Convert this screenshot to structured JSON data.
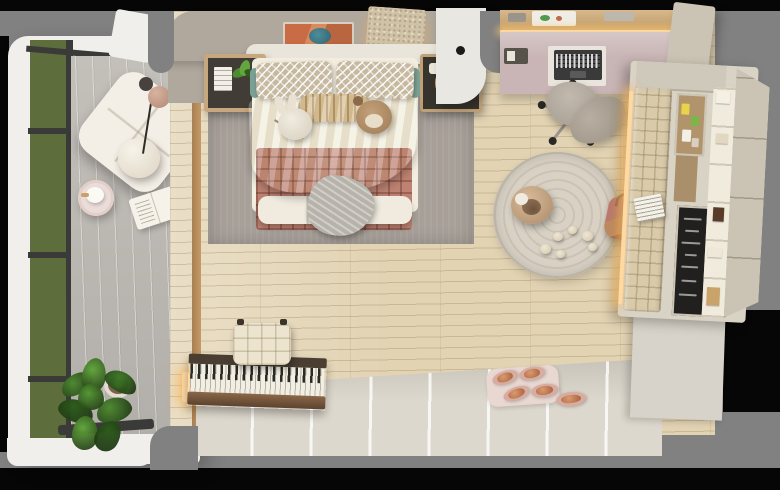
{
  "scene": {
    "description": "Top-down 3D render of a kids/teen bedroom with attached glazed reading balcony, double bed, desk nook, reading bench unit and piano",
    "view": "bird's-eye floor plan render on grey canvas with black letterbox bars"
  },
  "palette": {
    "bg": "#818181",
    "balconyWall": "#f0efec",
    "balconyFloor": "#cbc7c1",
    "windowFrame": "#3a3a38",
    "oakFloor": "#e2d3b3",
    "bedWall": "#b0a89d",
    "headboard": "#eae5da",
    "rugGray": "#a79f98",
    "sheet": "#f2edde",
    "duvet": "#e8d9b8",
    "quilt": "#bd8272",
    "throwGray": "#b7b3ab",
    "pillowPattern": "#c7b9a0",
    "tealAccent": "#7ba195",
    "nightstandDark": "#413c35",
    "divider": "#e9e7e1",
    "deskPink": "#c9b5b5",
    "ledGlow": "#ffd9a2",
    "chair": "#b2a89d",
    "unitFrame": "#d9d3c6",
    "bench": "#d9caaa",
    "cork": "#b1946c",
    "chalk": "#21201e",
    "shelfWhite": "#f0ebdd",
    "wardrobe": "#cbc4b4",
    "roundRug": "#d5cec1",
    "mat": "#e9d8d2",
    "panelWall": "#ddd8cd",
    "keys": "#f2eee1",
    "benchCushion": "#ece4cf",
    "lounge": "#f4efe6",
    "tableBlush": "#eadcd8"
  },
  "objects": [
    "glazed window wall with garden view",
    "white tufted lounge chair",
    "pendant lamp over lounge",
    "blush round side table with teapot",
    "open book on floor",
    "potted fiddle-leaf plant",
    "double bed with patterned pillows",
    "bunny plush",
    "deer plush",
    "pink quilted blanket",
    "grey knit throw",
    "left nightstand with magazines and plant",
    "right nightstand with gold tray",
    "abstract wall art",
    "sparkle acoustic panel with LED",
    "grey area rug",
    "pink study desk with laptop and shelf",
    "swivel desk chair",
    "tall beige cabinet",
    "reading nook: tufted bench, cork boards, chalkboard, cube shelves, wardrobe doors",
    "magazine on bench",
    "round cream rug",
    "donut floor pouf",
    "scattered plush toys",
    "rose handbag",
    "upright piano with LED underglow",
    "tufted piano bench",
    "panelled lower wall",
    "blush mat with slippers"
  ],
  "chair_leg_angles": [
    200,
    272,
    344,
    56,
    128
  ],
  "chalk_lines": [
    {
      "x": 5,
      "y": 10,
      "w": 18
    },
    {
      "x": 7,
      "y": 22,
      "w": 14
    },
    {
      "x": 4,
      "y": 34,
      "w": 19
    },
    {
      "x": 8,
      "y": 46,
      "w": 12
    },
    {
      "x": 5,
      "y": 58,
      "w": 17
    },
    {
      "x": 6,
      "y": 72,
      "w": 15
    },
    {
      "x": 4,
      "y": 86,
      "w": 18
    }
  ],
  "cork_pins": [
    {
      "x": 3,
      "y": 8,
      "w": 8,
      "h": 11,
      "c": "#e8d44a"
    },
    {
      "x": 13,
      "y": 20,
      "w": 8,
      "h": 10,
      "c": "#7ab648"
    },
    {
      "x": 5,
      "y": 34,
      "w": 9,
      "h": 12,
      "c": "#f2efe6"
    },
    {
      "x": 15,
      "y": 42,
      "w": 7,
      "h": 9,
      "c": "#d8cfc0"
    }
  ],
  "shelf_books": [
    {
      "x": 3,
      "y": 4,
      "w": 14,
      "h": 12,
      "c": "#f4f0e4"
    },
    {
      "x": 5,
      "y": 46,
      "w": 12,
      "h": 10,
      "c": "#e2d8c2"
    },
    {
      "x": 6,
      "y": 120,
      "w": 11,
      "h": 14,
      "c": "#5a3a28"
    },
    {
      "x": 3,
      "y": 160,
      "w": 14,
      "h": 10,
      "c": "#efe8d8"
    },
    {
      "x": 4,
      "y": 200,
      "w": 13,
      "h": 18,
      "c": "#caa36a"
    }
  ],
  "rug_toys": [
    {
      "x": 540,
      "y": 244,
      "s": 11
    },
    {
      "x": 556,
      "y": 250,
      "s": 9
    },
    {
      "x": 553,
      "y": 232,
      "s": 10
    },
    {
      "x": 568,
      "y": 226,
      "s": 9
    },
    {
      "x": 582,
      "y": 231,
      "s": 11
    },
    {
      "x": 588,
      "y": 243,
      "s": 9
    }
  ],
  "slippers": [
    {
      "x": 492,
      "y": 371,
      "w": 26,
      "h": 13,
      "r": -18
    },
    {
      "x": 519,
      "y": 367,
      "w": 26,
      "h": 13,
      "r": -12
    },
    {
      "x": 503,
      "y": 387,
      "w": 27,
      "h": 13,
      "r": -20
    },
    {
      "x": 531,
      "y": 384,
      "w": 27,
      "h": 13,
      "r": -8
    },
    {
      "x": 556,
      "y": 392,
      "w": 30,
      "h": 14,
      "r": -6
    }
  ],
  "plant_leaves": [
    {
      "x": 8,
      "y": 18,
      "w": 34,
      "h": 20,
      "r": -30,
      "c": "#4e8a32"
    },
    {
      "x": 30,
      "y": 2,
      "w": 24,
      "h": 34,
      "r": 10,
      "c": "#63a63e"
    },
    {
      "x": 52,
      "y": 16,
      "w": 34,
      "h": 20,
      "r": 28,
      "c": "#3f7a28"
    },
    {
      "x": 6,
      "y": 44,
      "w": 36,
      "h": 22,
      "r": 20,
      "c": "#2f5c1e"
    },
    {
      "x": 44,
      "y": 42,
      "w": 36,
      "h": 24,
      "r": -18,
      "c": "#4e8a32"
    },
    {
      "x": 20,
      "y": 60,
      "w": 26,
      "h": 34,
      "r": 4,
      "c": "#63a63e"
    },
    {
      "x": 44,
      "y": 64,
      "w": 24,
      "h": 32,
      "r": 30,
      "c": "#2f5c1e"
    },
    {
      "x": 26,
      "y": 28,
      "w": 26,
      "h": 26,
      "r": 0,
      "c": "#559635"
    }
  ],
  "ns_plant_leaves": [
    {
      "x": 0,
      "y": 8,
      "w": 16,
      "h": 9,
      "r": -20,
      "c": "#4e8a32"
    },
    {
      "x": 8,
      "y": 0,
      "w": 10,
      "h": 16,
      "r": 15,
      "c": "#63a63e"
    },
    {
      "x": 12,
      "y": 10,
      "w": 15,
      "h": 8,
      "r": 30,
      "c": "#2f5c1e"
    }
  ]
}
